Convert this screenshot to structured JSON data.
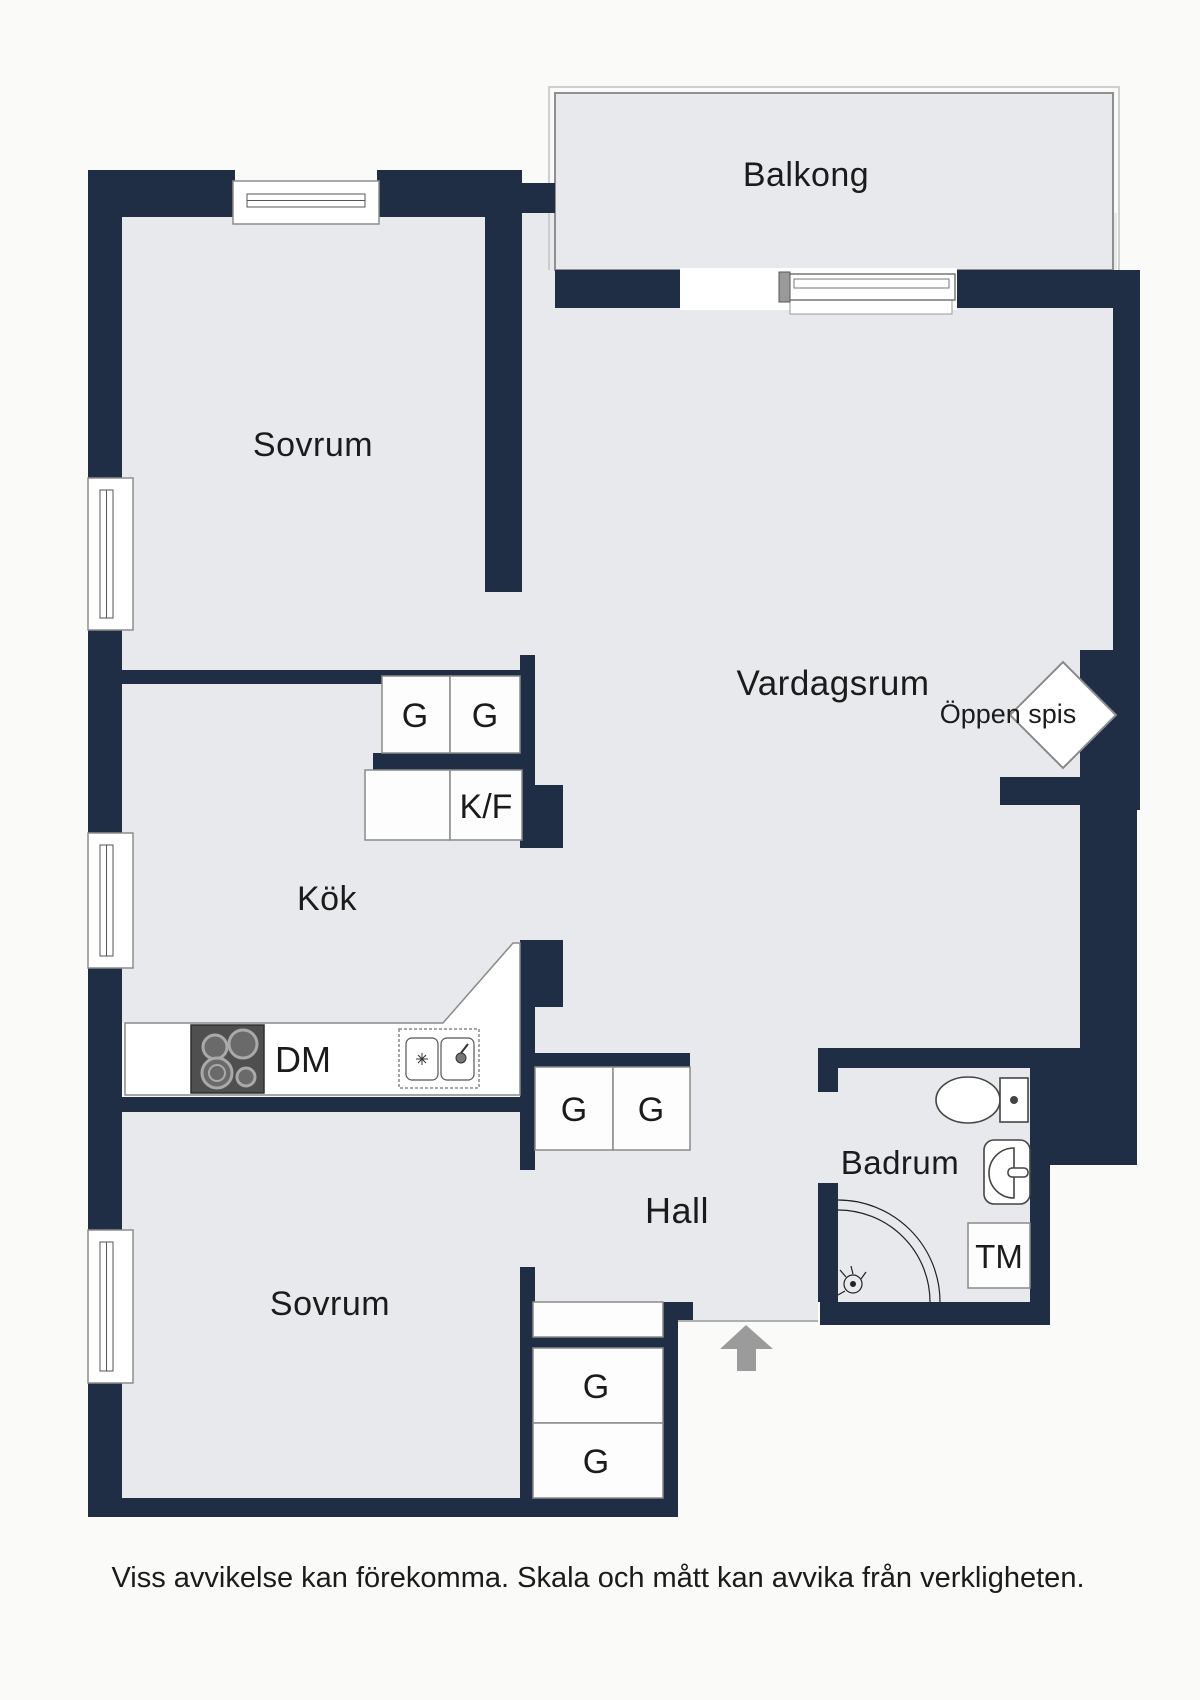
{
  "colors": {
    "wall": "#1f2e44",
    "floor": "#e8e9ec",
    "background": "#fafaf8",
    "fixture_border": "#8a8a8a",
    "arrow": "#9b9b9b",
    "text": "#1b1b1b"
  },
  "labels": {
    "balcony": "Balkong",
    "bedroom_top": "Sovrum",
    "living_room": "Vardagsrum",
    "open_fireplace": "Öppen spis",
    "kitchen": "Kök",
    "hall": "Hall",
    "bedroom_bottom": "Sovrum",
    "bathroom": "Badrum",
    "wardrobe": "G",
    "fridge_freezer": "K/F",
    "dishwasher": "DM",
    "washing_machine": "TM"
  },
  "footer": {
    "disclaimer": "Viss avvikelse kan förekomma. Skala och mått kan avvika från verkligheten."
  }
}
